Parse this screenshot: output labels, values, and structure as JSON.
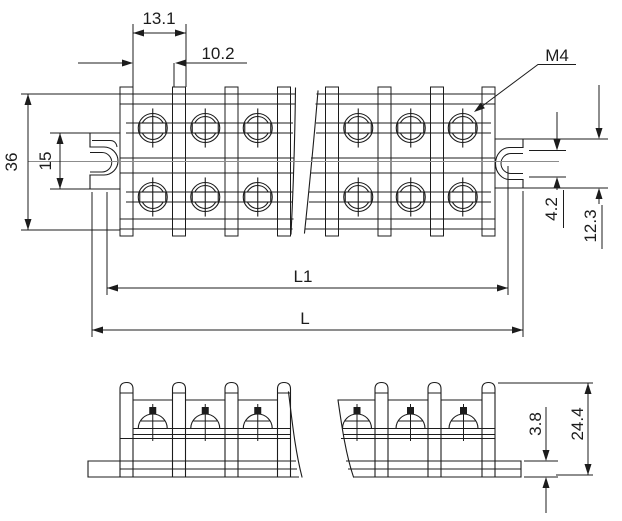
{
  "drawing": {
    "type": "engineering-dimension-drawing",
    "subject": "dual-row barrier terminal block, top plan view and front elevation views",
    "labels": {
      "pitch": "13.1",
      "clearance": "10.2",
      "thread": "M4",
      "body_width": "36",
      "left_ear_height": "15",
      "slot_height": "4.2",
      "right_ear_height": "12.3",
      "inner_length": "L1",
      "overall_length": "L",
      "base_thickness": "3.8",
      "overall_height": "24.4"
    },
    "colors": {
      "line": "#1c1c1c",
      "center_line": "#8c8c8c",
      "background": "#ffffff"
    }
  }
}
